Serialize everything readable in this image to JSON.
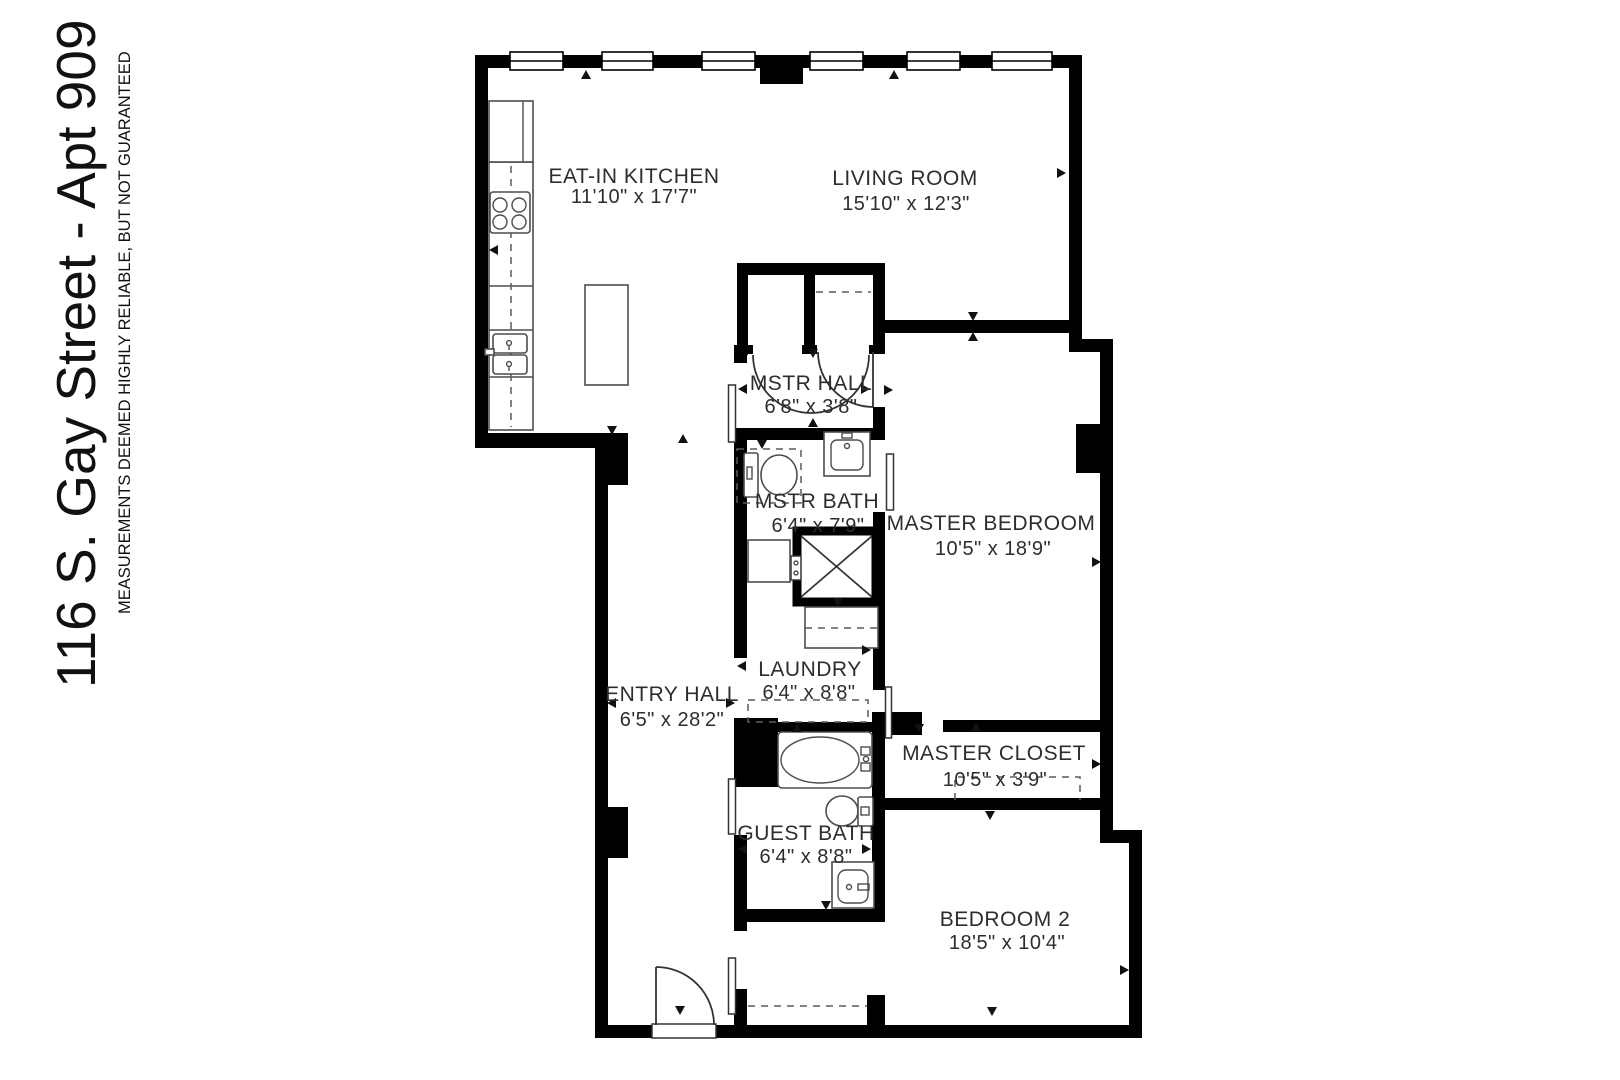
{
  "title": "116 S. Gay Street - Apt 909",
  "disclaimer": "MEASUREMENTS DEEMED HIGHLY RELIABLE, BUT NOT GUARANTEED",
  "colors": {
    "wall": "#000000",
    "background": "#ffffff",
    "text": "#2d2d2d",
    "fixture_line": "#4d4d4d"
  },
  "rooms": [
    {
      "name": "EAT-IN KITCHEN",
      "dimensions": "11'10\" x 17'7\""
    },
    {
      "name": "LIVING ROOM",
      "dimensions": "15'10\" x 12'3\""
    },
    {
      "name": "MSTR HALL",
      "dimensions": "6'8\" x 3'8\""
    },
    {
      "name": "MSTR BATH",
      "dimensions": "6'4\" x 7'9\""
    },
    {
      "name": "MASTER BEDROOM",
      "dimensions": "10'5\" x 18'9\""
    },
    {
      "name": "ENTRY HALL",
      "dimensions": "6'5\" x 28'2\""
    },
    {
      "name": "LAUNDRY",
      "dimensions": "6'4\" x 8'8\""
    },
    {
      "name": "MASTER CLOSET",
      "dimensions": "10'5\" x 3'9\""
    },
    {
      "name": "GUEST BATH",
      "dimensions": "6'4\" x 8'8\""
    },
    {
      "name": "BEDROOM 2",
      "dimensions": "18'5\" x 10'4\""
    }
  ]
}
